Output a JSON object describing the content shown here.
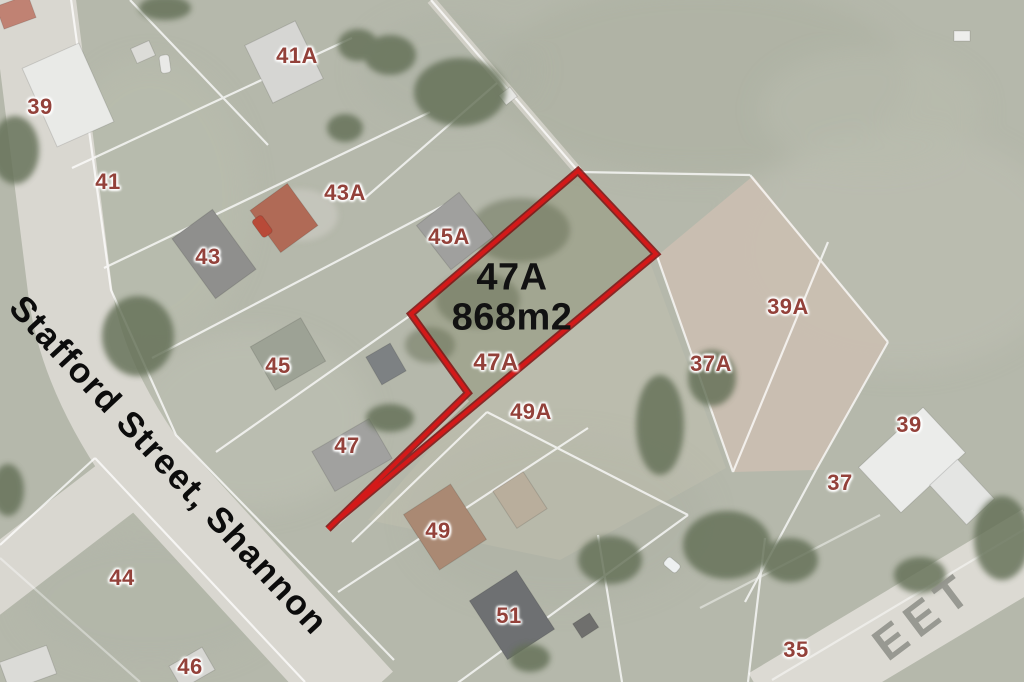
{
  "map": {
    "parcel": {
      "lot": "47A",
      "area": "868m2"
    },
    "street_label": "Stafford Street, Shannon",
    "street_label_partial": "EET",
    "lot_labels": [
      {
        "text": "39"
      },
      {
        "text": "41A"
      },
      {
        "text": "41"
      },
      {
        "text": "43A"
      },
      {
        "text": "43"
      },
      {
        "text": "45A"
      },
      {
        "text": "45"
      },
      {
        "text": "47"
      },
      {
        "text": "47A"
      },
      {
        "text": "49A"
      },
      {
        "text": "49"
      },
      {
        "text": "51"
      },
      {
        "text": "44"
      },
      {
        "text": "46"
      },
      {
        "text": "37A"
      },
      {
        "text": "39A"
      },
      {
        "text": "39"
      },
      {
        "text": "37"
      },
      {
        "text": "35"
      }
    ],
    "colors": {
      "boundary_red": "#d31919",
      "lot_label_red": "#93413a",
      "road": "#d9d7d0",
      "grass": "#b5b8ab",
      "bare_parcel_tan": "#cbbfb1"
    }
  }
}
